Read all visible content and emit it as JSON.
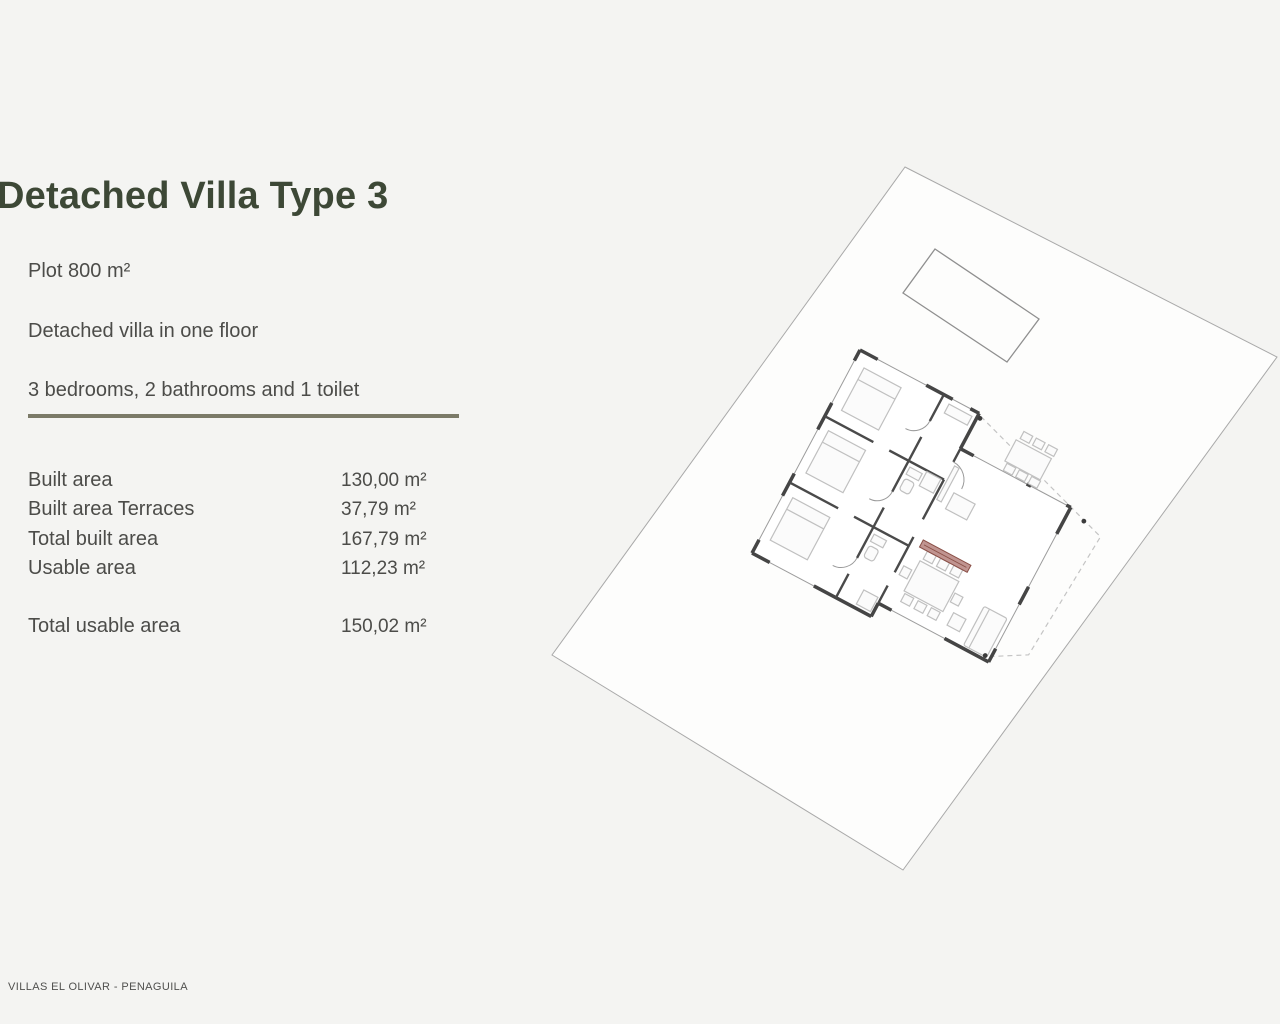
{
  "page": {
    "title": "Detached Villa Type 3",
    "footer": "VILLAS EL OLIVAR - PENAGUILA"
  },
  "description": {
    "line1": "Plot 800 m²",
    "line2": "Detached villa in one floor",
    "line3": "3 bedrooms, 2 bathrooms and 1 toilet"
  },
  "areas": {
    "rows": [
      {
        "label": "Built area",
        "value": "130,00 m²"
      },
      {
        "label": "Built area Terraces",
        "value": "37,79 m²"
      },
      {
        "label": "Total built area",
        "value": "167,79 m²"
      },
      {
        "label": "Usable area",
        "value": "112,23 m²"
      }
    ],
    "total": {
      "label": "Total usable area",
      "value": "150,02 m²"
    }
  },
  "colors": {
    "title_green": "#3d4836",
    "divider_olive": "#7b7a68",
    "accent_red": "#8a4f46",
    "wall_dark": "#454545",
    "page_background": "#f4f4f2"
  }
}
